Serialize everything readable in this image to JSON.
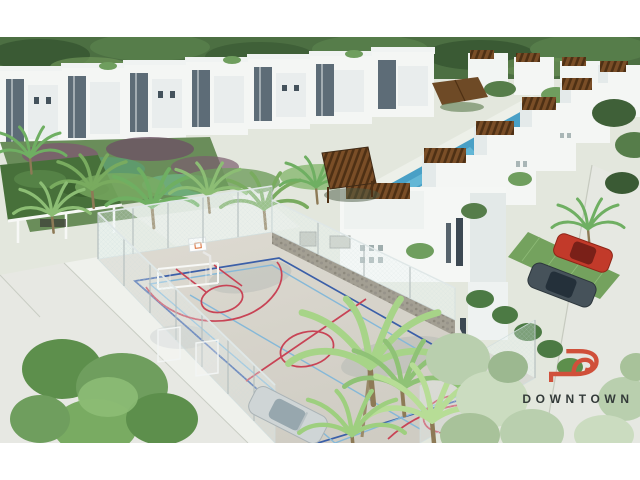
{
  "image": {
    "kind": "architectural-aerial-render",
    "subject": "Residential development with white villas, palm gardens and a fenced multi-sport court"
  },
  "logo": {
    "brand": "DOWNTOWN",
    "icon": "downtown-d-arrow-icon",
    "accent_color": "#d0503a",
    "text_color": "#333a39"
  },
  "palette": {
    "canvas_bg": "#ffffff",
    "tree_band": "#4c6f42",
    "vegetation": "#6f9e5e",
    "house_white": "#f4f6f4",
    "house_shade": "#e4eaea",
    "slate_panel": "#5d6c77",
    "court_surface": "#d8d5cc",
    "court_line_red": "#c84355",
    "court_line_blue": "#3b5fa8",
    "court_line_lightblue": "#85b8d8",
    "pool_blue": "#49a0c6",
    "pergola_brown": "#7a4e27",
    "street": "#e7e8e3",
    "stone_wall": "#a39f93"
  }
}
